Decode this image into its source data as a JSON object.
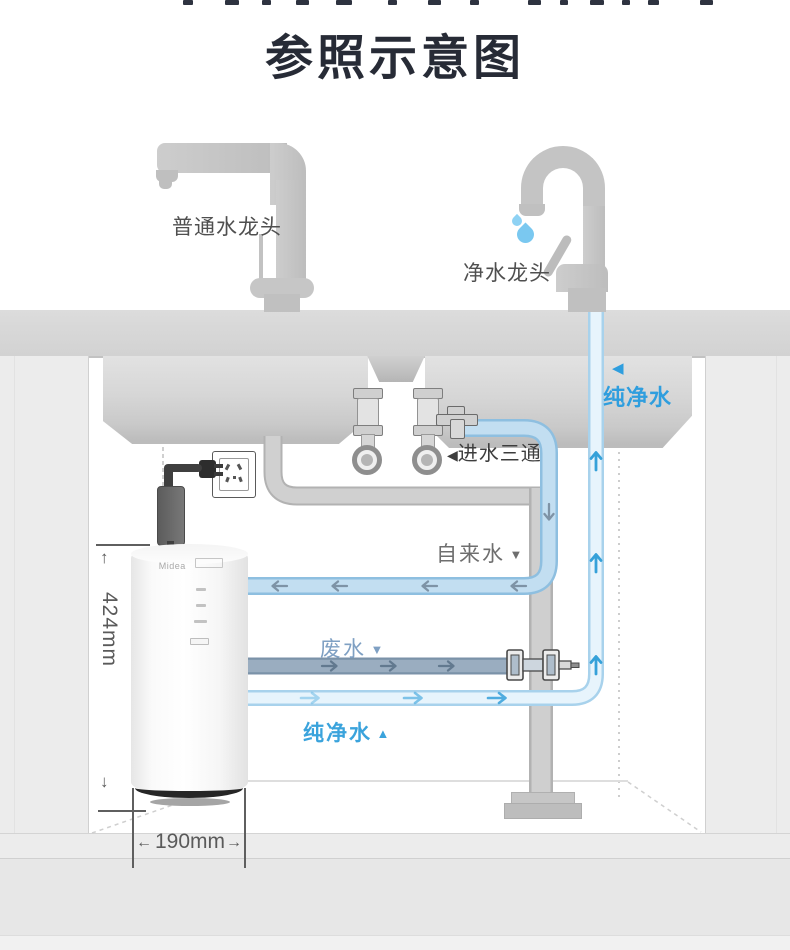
{
  "title": "参照示意图",
  "labels": {
    "faucet_ordinary": "普通水龙头",
    "faucet_purified": "净水龙头",
    "pure_water_top": "纯净水",
    "tap_water": "自来水",
    "waste_water": "废水",
    "pure_water_bottom": "纯净水",
    "inlet_tee": "进水三通",
    "tri_left": "◀",
    "tri_down": "▼",
    "tri_up": "▲"
  },
  "dimensions": {
    "device_height": "424mm",
    "device_width": "190mm",
    "arrow_up": "↑",
    "arrow_down": "↓",
    "arrow_left": "←",
    "arrow_right": "→"
  },
  "device": {
    "brand": "Midea"
  },
  "colors": {
    "accent_blue": "#2f9ede",
    "pipe_tap_fill": "#c2def1",
    "pipe_tap_edge": "#8ebfe0",
    "pipe_pure_fill": "#e7f4fc",
    "pipe_pure_edge": "#a8d2ec",
    "pipe_waste_fill": "#9aadc0",
    "pipe_waste_edge": "#7b92a8",
    "pipe_drain_fill": "#cfcfcf",
    "pipe_drain_edge": "#b2b2b2",
    "waste_label_blue": "#7fa0c3",
    "label_gray": "#6e6e6e",
    "title_color": "#272b36",
    "faucet_gray": "#c4c4c4",
    "drop_blue": "#86cdf2"
  }
}
